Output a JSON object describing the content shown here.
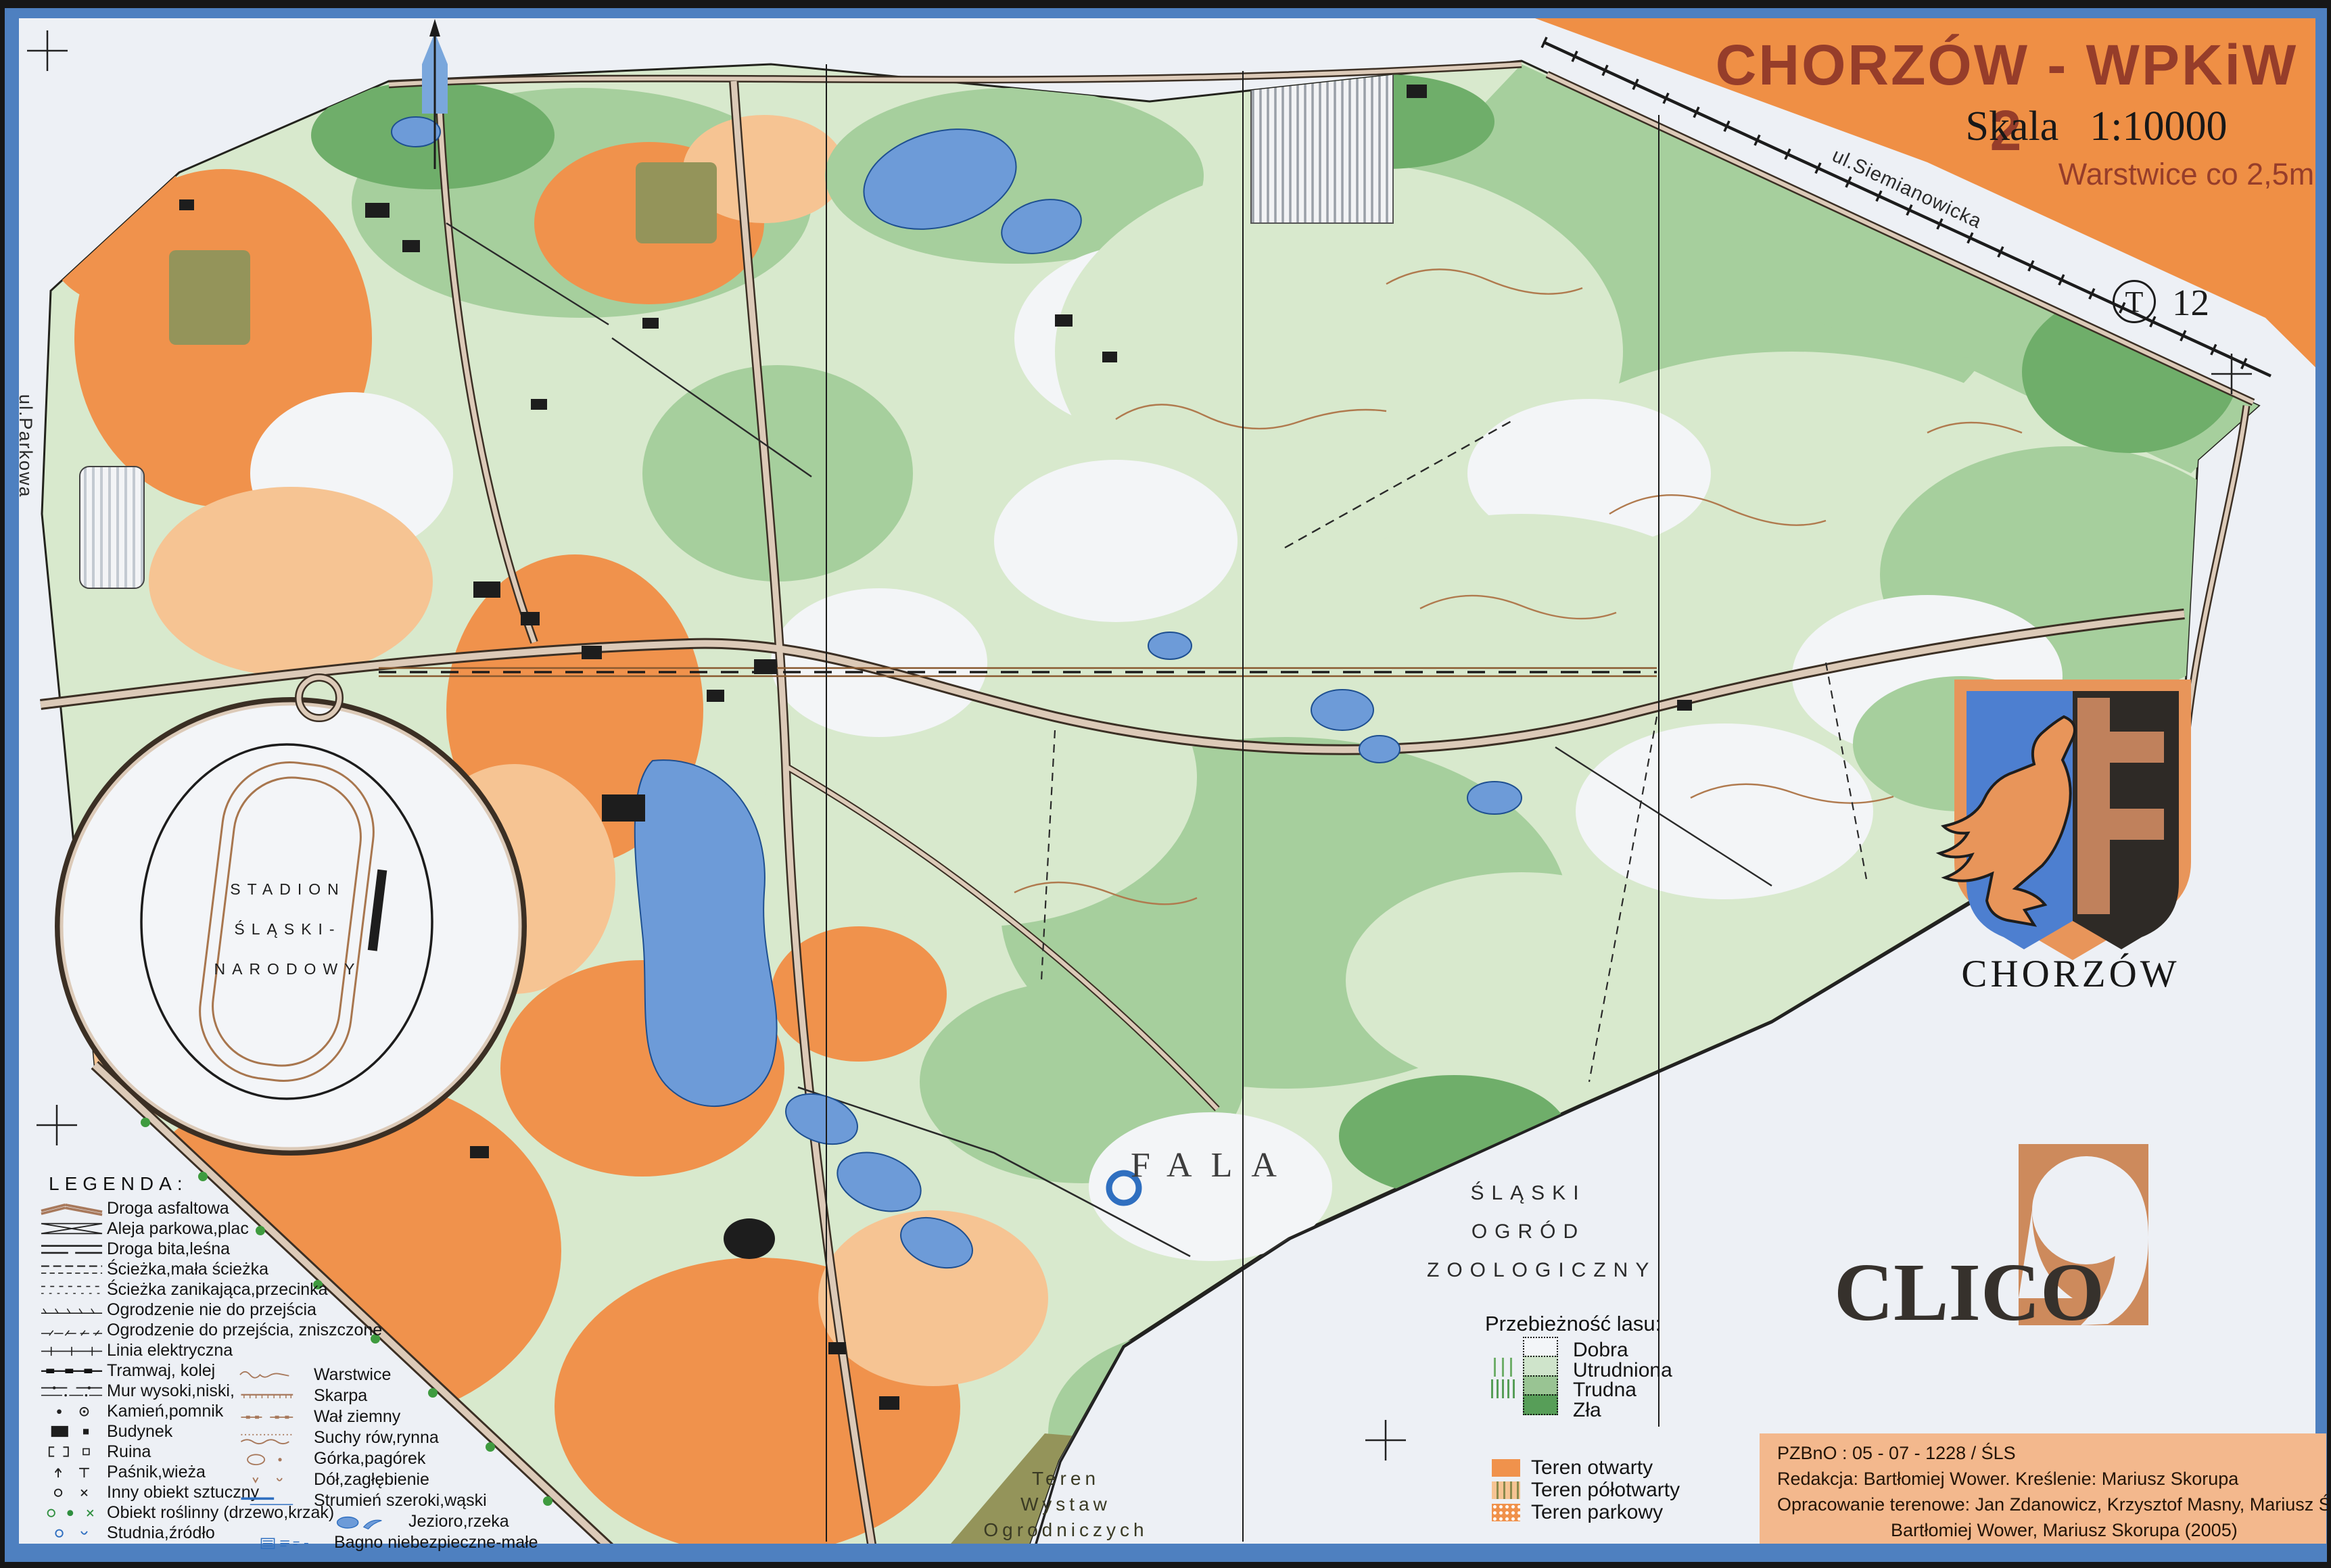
{
  "title_block": {
    "title": "CHORZÓW - WPKiW 2",
    "scale_word": "Skala",
    "scale_value": "1:10000",
    "contour_note": "Warstwice co 2,5m"
  },
  "map_code": {
    "letter": "T",
    "number": "12"
  },
  "streets": {
    "top_right": "ul.Siemianowicka",
    "left": "ul.Parkowa"
  },
  "places": {
    "stadium": [
      "STADION",
      "ŚLĄSKI-",
      "NARODOWY"
    ],
    "fala": "FALA",
    "zoo": [
      "ŚLĄSKI",
      "OGRÓD",
      "ZOOLOGICZNY"
    ],
    "exhibition": [
      "Teren",
      "Wystaw",
      "Ogrodniczych"
    ]
  },
  "legend": {
    "heading": "LEGENDA:",
    "column1": [
      {
        "icon": "droga-asfaltowa",
        "label": "Droga asfaltowa"
      },
      {
        "icon": "aleja-parkowa",
        "label": "Aleja parkowa,plac"
      },
      {
        "icon": "droga-bita",
        "label": "Droga bita,leśna"
      },
      {
        "icon": "sciezka",
        "label": "Ścieżka,mała ścieżka"
      },
      {
        "icon": "sciezka-zanikajaca",
        "label": "Ścieżka zanikająca,przecinka"
      },
      {
        "icon": "ogrodzenie-nie",
        "label": "Ogrodzenie nie do przejścia"
      },
      {
        "icon": "ogrodzenie-do",
        "label": "Ogrodzenie do przejścia, zniszczone"
      },
      {
        "icon": "linia-elektryczna",
        "label": "Linia elektryczna"
      },
      {
        "icon": "tramwaj-kolej",
        "label": "Tramwaj, kolej"
      },
      {
        "icon": "mur",
        "label": "Mur wysoki,niski,"
      },
      {
        "icon": "kamien-pomnik",
        "label": "Kamień,pomnik"
      },
      {
        "icon": "budynek",
        "label": "Budynek"
      },
      {
        "icon": "ruina",
        "label": "Ruina"
      },
      {
        "icon": "pasnik-wieza",
        "label": "Paśnik,wieża"
      },
      {
        "icon": "inny-obiekt",
        "label": "Inny obiekt sztuczny"
      },
      {
        "icon": "obiekt-roslinny",
        "label": "Obiekt roślinny (drzewo,krzak)"
      },
      {
        "icon": "studnia-zrodlo",
        "label": "Studnia,źródło"
      }
    ],
    "column2": [
      {
        "icon": "warstwice",
        "label": "Warstwice"
      },
      {
        "icon": "skarpa",
        "label": "Skarpa"
      },
      {
        "icon": "wal-ziemny",
        "label": "Wał ziemny"
      },
      {
        "icon": "suchy-row",
        "label": "Suchy rów,rynna"
      },
      {
        "icon": "gorka-pagorek",
        "label": "Górka,pagórek"
      },
      {
        "icon": "dol-zaglebienie",
        "label": "Dół,zagłębienie"
      },
      {
        "icon": "strumien",
        "label": "Strumień szeroki,wąski"
      },
      {
        "icon": "jezioro-rzeka",
        "label": "Jezioro,rzeka",
        "indent": 140
      },
      {
        "icon": "bagno",
        "label": "Bagno niebezpieczne-małe",
        "indent": 30
      }
    ]
  },
  "runnability": {
    "heading": "Przebieżność lasu:",
    "items": [
      {
        "label": "Dobra",
        "swatch": "run-good"
      },
      {
        "label": "Utrudniona",
        "swatch": "run-slow"
      },
      {
        "label": "Trudna",
        "swatch": "run-hard"
      },
      {
        "label": "Zła",
        "swatch": "run-bad"
      }
    ]
  },
  "terrain_types": {
    "items": [
      {
        "label": "Teren otwarty",
        "swatch": "sw-open"
      },
      {
        "label": "Teren półotwarty",
        "swatch": "sw-semiopen"
      },
      {
        "label": "Teren parkowy",
        "swatch": "sw-park"
      }
    ]
  },
  "branding": {
    "city": "CHORZÓW",
    "publisher": "CLICO"
  },
  "credits": {
    "lines": [
      "PZBnO : 05 - 07 - 1228 / ŚLS",
      "Redakcja: Bartłomiej Wower.   Kreślenie: Mariusz Skorupa",
      "Opracowanie terenowe: Jan Zdanowicz, Krzysztof Masny, Mariusz Śliwka (1997),",
      "Bartłomiej Wower, Mariusz Skorupa (2005)"
    ]
  },
  "colors": {
    "header_orange": "#ef8f45",
    "title_text": "#963d2a",
    "frame_blue": "#4e80c0",
    "water_blue": "#6d9bd8",
    "forest_green": "#a6cf9d",
    "open_orange": "#f0924c",
    "olive": "#94945a",
    "credits_panel": "#f3b88d"
  }
}
